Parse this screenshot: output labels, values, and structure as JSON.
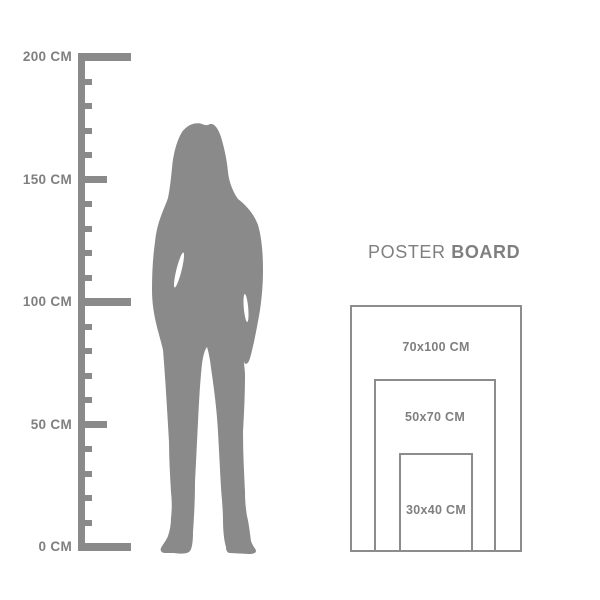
{
  "colors": {
    "background": "#ffffff",
    "shape_gray": "#8a8a8a",
    "text_gray": "#7f7f7f",
    "rect_border": "#8c8c8c"
  },
  "ruler": {
    "unit": "CM",
    "min_cm": 0,
    "max_cm": 200,
    "tick_step_cm": 10,
    "labeled_ticks": [
      {
        "cm": 200,
        "label": "200 CM"
      },
      {
        "cm": 150,
        "label": "150 CM"
      },
      {
        "cm": 100,
        "label": "100 CM"
      },
      {
        "cm": 50,
        "label": "50 CM"
      },
      {
        "cm": 0,
        "label": "0 CM"
      }
    ]
  },
  "silhouette": {
    "description": "gray silhouette of a standing woman with long hair, ankle boots"
  },
  "poster": {
    "title_regular": "POSTER",
    "title_bold": "BOARD",
    "sizes": [
      {
        "label": "70x100 CM"
      },
      {
        "label": "50x70 CM"
      },
      {
        "label": "30x40 CM"
      }
    ]
  }
}
